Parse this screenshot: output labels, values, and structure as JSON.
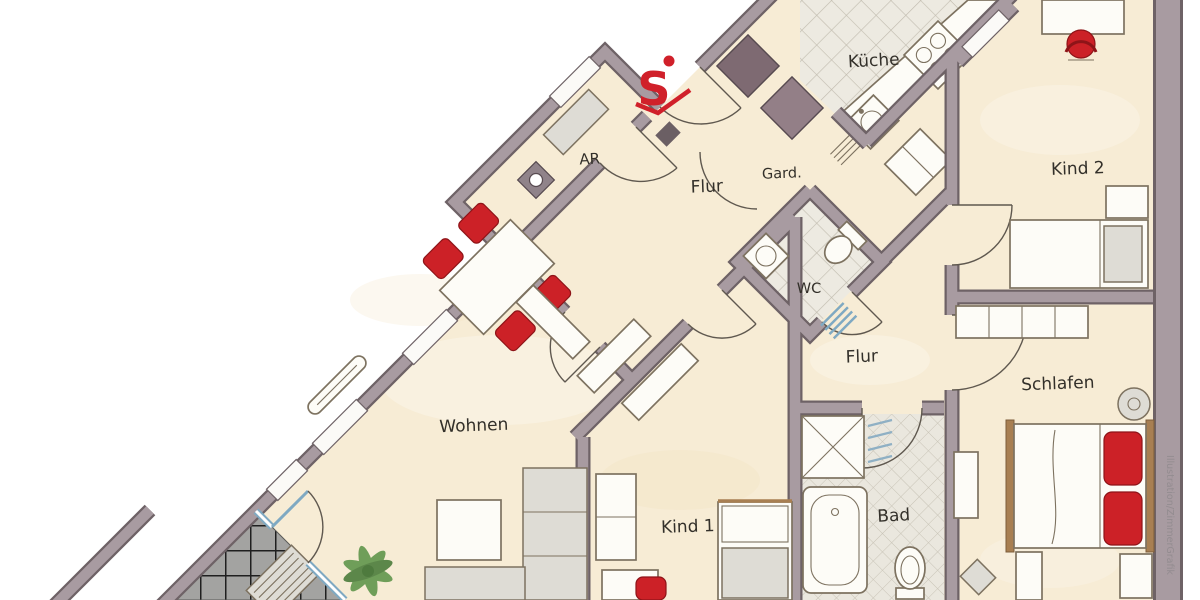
{
  "labels": {
    "ar": "AR",
    "flur_nord": "Flur",
    "gard": "Gard.",
    "kueche": "Küche",
    "kind2": "Kind 2",
    "wc": "WC",
    "flur_ost": "Flur",
    "wohnen": "Wohnen",
    "kind1": "Kind 1",
    "bad": "Bad",
    "schlafen": "Schlafen"
  },
  "logo": {
    "letter": "S"
  },
  "watermark": "Illustration/ZimmerGrafik",
  "colors": {
    "wallFill": "#a89ba1",
    "wallOutline": "#6e6266",
    "floor": "#f7ecd5",
    "accentRed": "#cc2127",
    "logoRed": "#d0202a",
    "glassBlue": "#7fa9c2",
    "tileFloor": "#edeae1",
    "tileLine": "#c2bdb0",
    "badTile": "#eae7de",
    "balconyTile": "#a3a3a1",
    "balconyLine": "#1f1f1f",
    "shaftDark": "#7e6a72",
    "shaftLight": "#937f87",
    "plantGreen": "#6f9e59",
    "furnitureStroke": "#7d7260",
    "woodBrown": "#a87f52",
    "labelInk": "#33302a",
    "watermarkGrey": "#938c90"
  }
}
